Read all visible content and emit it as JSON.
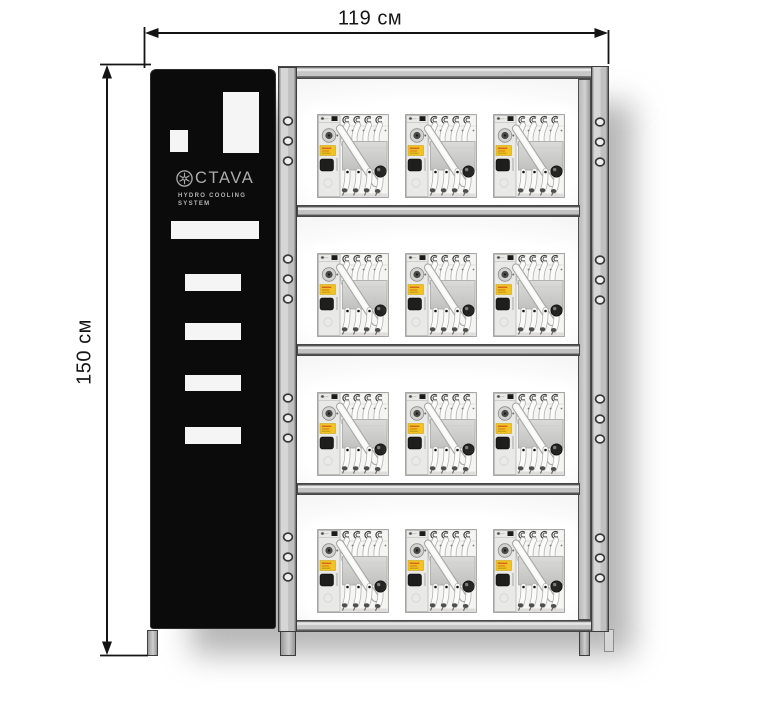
{
  "dimensions": {
    "width_label": "119 см",
    "height_label": "150 см"
  },
  "brand_panel": {
    "logo_icon": "snowflake-icon",
    "logo_text": "CTAVA",
    "subtitle_line1": "HYDRO COOLING",
    "subtitle_line2": "SYSTEM"
  },
  "rack": {
    "shelf_count": 4,
    "units_per_shelf": 3,
    "total_units": 12
  },
  "colors": {
    "frame_gray": "#c6c6c6",
    "panel_black": "#0b0b0b",
    "label_yellow": "#f0c322",
    "dimension_line": "#141414",
    "background": "#ffffff"
  }
}
